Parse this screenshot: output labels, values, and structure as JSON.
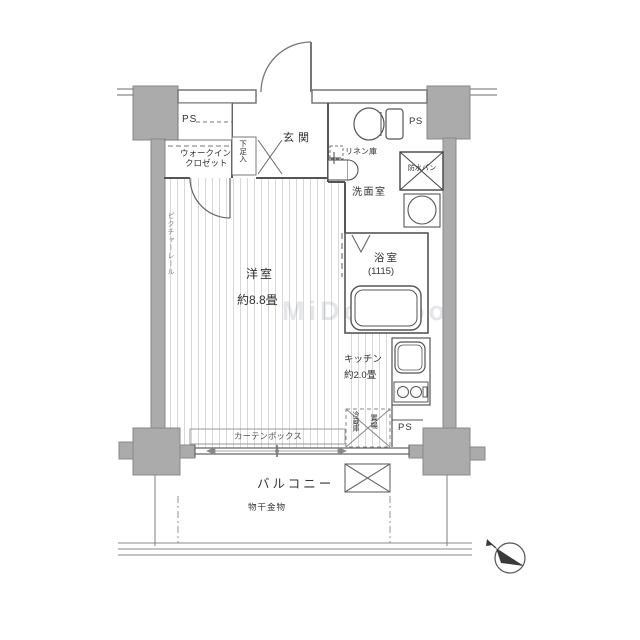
{
  "plan_title": "apartment-floor-plan",
  "labels": {
    "ps_top_left": "PS",
    "walk_in_closet_1": "ウォークイン",
    "walk_in_closet_2": "クロゼット",
    "shoe_cabinet": "下足入",
    "entrance": "玄関",
    "linen_closet": "リネン庫",
    "ps_top_right": "PS",
    "waterproof_pan": "防水パン",
    "washroom": "洗面室",
    "bathroom": "浴室",
    "bathroom_size": "(1115)",
    "main_room": "洋室",
    "main_room_size": "約8.8畳",
    "picture_rail": "ピクチャーレール",
    "kitchen": "キッチン",
    "kitchen_size": "約2.0畳",
    "refrigerator_1": "冷蔵庫",
    "refrigerator_2": "置場",
    "ps_bottom_right": "PS",
    "curtain_box": "カーテンボックス",
    "balcony": "バルコニー",
    "laundry_hardware": "物干金物",
    "watermark": "MiDooRoo"
  },
  "colors": {
    "wall_fill": "#ababab",
    "wall_outline": "#8a8a8a",
    "line": "#555555",
    "floor_stripe": "#d8d8d8",
    "text": "#333333"
  }
}
